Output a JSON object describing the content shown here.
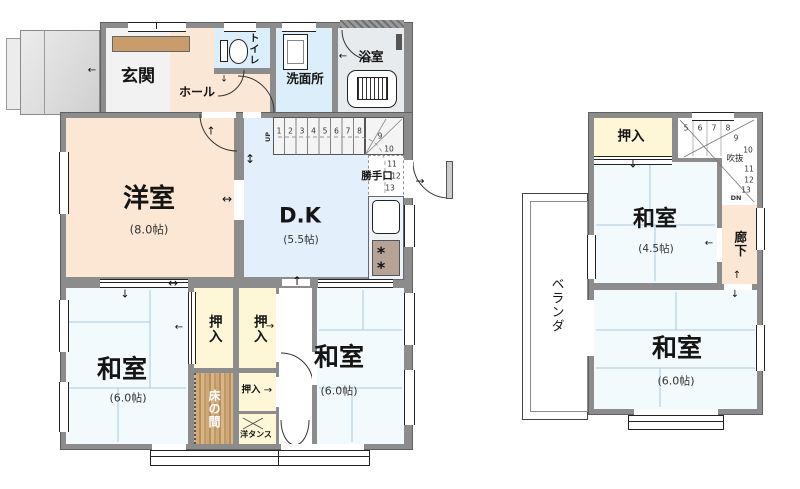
{
  "icons": {
    "arrow_left": "←",
    "arrow_right": "→",
    "arrow_up": "↑",
    "arrow_down": "↓",
    "arrow_v": "↕",
    "arrow_h": "↔",
    "burner": "*"
  },
  "floor1": {
    "genkan": "玄関",
    "hall": "ホール",
    "toilet": "トイレ",
    "washroom": "洗面所",
    "bath": "浴室",
    "dk": "D.K",
    "dk_size": "(5.5帖)",
    "western": "洋室",
    "western_size": "(8.0帖)",
    "tatami_left": "和室",
    "tatami_left_size": "(6.0帖)",
    "tatami_right": "和室",
    "tatami_right_size": "(6.0帖)",
    "closet1": "押入",
    "closet2": "押入",
    "closet3": "押入",
    "tokonoma": "床の間",
    "wardrobe": "洋タンス",
    "backdoor": "勝手口",
    "stairs_up": "UP",
    "steps": [
      "1",
      "2",
      "3",
      "4",
      "5",
      "6",
      "7",
      "8",
      "9",
      "10",
      "11",
      "12",
      "13"
    ]
  },
  "floor2": {
    "closet": "押入",
    "tatami_small": "和室",
    "tatami_small_size": "(4.5帖)",
    "corridor": "廊下",
    "tatami_large": "和室",
    "tatami_large_size": "(6.0帖)",
    "veranda": "ベランダ",
    "void": "吹抜",
    "stairs_down": "DN",
    "steps": [
      "5",
      "6",
      "7",
      "8",
      "9",
      "10",
      "11",
      "12",
      "13"
    ]
  },
  "colors": {
    "wall": "#8c8c8c",
    "tatami": "#f3fafd",
    "closet": "#fdf7d8",
    "wood": "#c8a06a",
    "room_peach": "#fbe7d3",
    "dk_blue": "#e3effb",
    "wet_blue": "#dceef9",
    "step_brown": "#c99c6b",
    "bath_gray": "#e8ebee"
  }
}
